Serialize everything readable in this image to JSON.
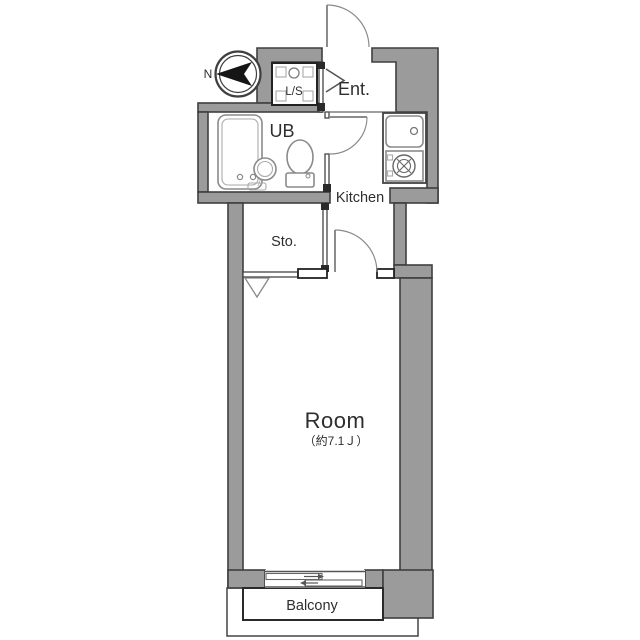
{
  "title": "apartment-floor-plan",
  "compass": {
    "label": "N"
  },
  "rooms": {
    "entrance": {
      "label": "Ent."
    },
    "laundry": {
      "label": "L/S"
    },
    "bath": {
      "label": "UB"
    },
    "kitchen": {
      "label": "Kitchen"
    },
    "storage": {
      "label": "Sto."
    },
    "room": {
      "label": "Room",
      "size": "（約7.1Ｊ）"
    },
    "balcony": {
      "label": "Balcony"
    }
  },
  "colors": {
    "wall_fill": "#9b9b9b",
    "wall_outline": "#3f3f3f",
    "thin_line": "#555555",
    "fixture_line": "#8a8a8a",
    "text": "#2e2e2e",
    "background": "#ffffff"
  }
}
